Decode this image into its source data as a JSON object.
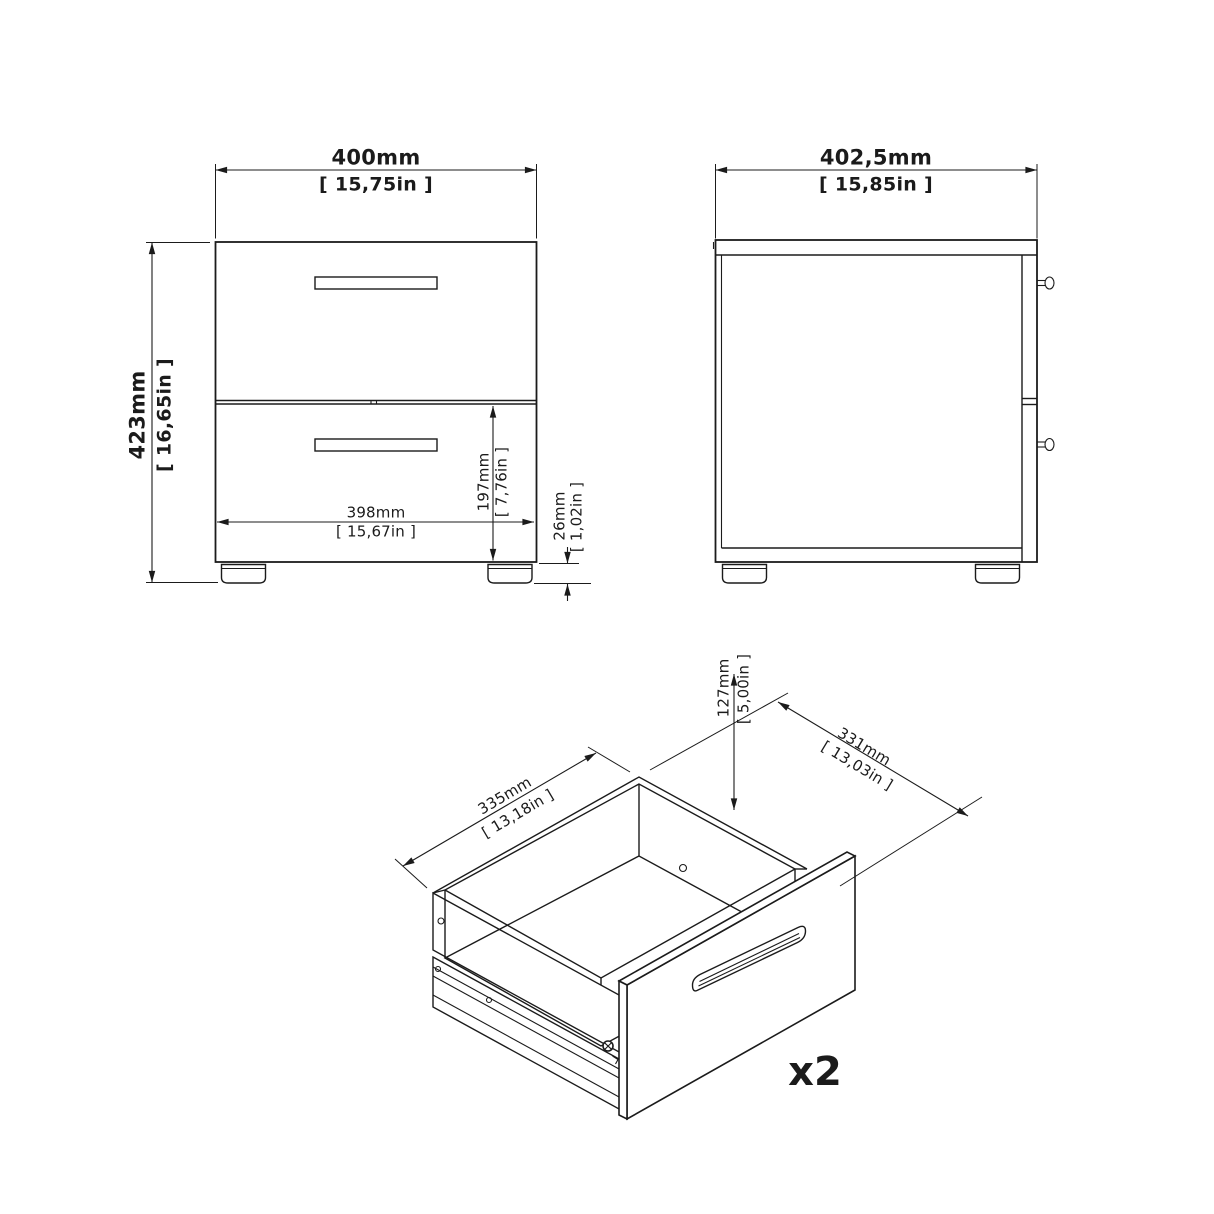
{
  "page": {
    "background": "#ffffff",
    "line_color": "#1b1b1b",
    "drawing_type": "furniture dimension drawing"
  },
  "front_view": {
    "width": {
      "mm": "400mm",
      "in": "[ 15,75in ]"
    },
    "height": {
      "mm": "423mm",
      "in": "[ 16,65in ]"
    },
    "inner_width": {
      "mm": "398mm",
      "in": "[ 15,67in ]"
    },
    "lower_drawer_height": {
      "mm": "197mm",
      "in": "[ 7,76in ]"
    },
    "foot_height": {
      "mm": "26mm",
      "in": "[ 1,02in ]"
    }
  },
  "side_view": {
    "depth": {
      "mm": "402,5mm",
      "in": "[ 15,85in ]"
    }
  },
  "drawer_view": {
    "inner_depth": {
      "mm": "335mm",
      "in": "[ 13,18in ]"
    },
    "inner_width": {
      "mm": "331mm",
      "in": "[ 13,03in ]"
    },
    "inner_height": {
      "mm": "127mm",
      "in": "[ 5,00in ]"
    },
    "quantity_label": "x2"
  }
}
